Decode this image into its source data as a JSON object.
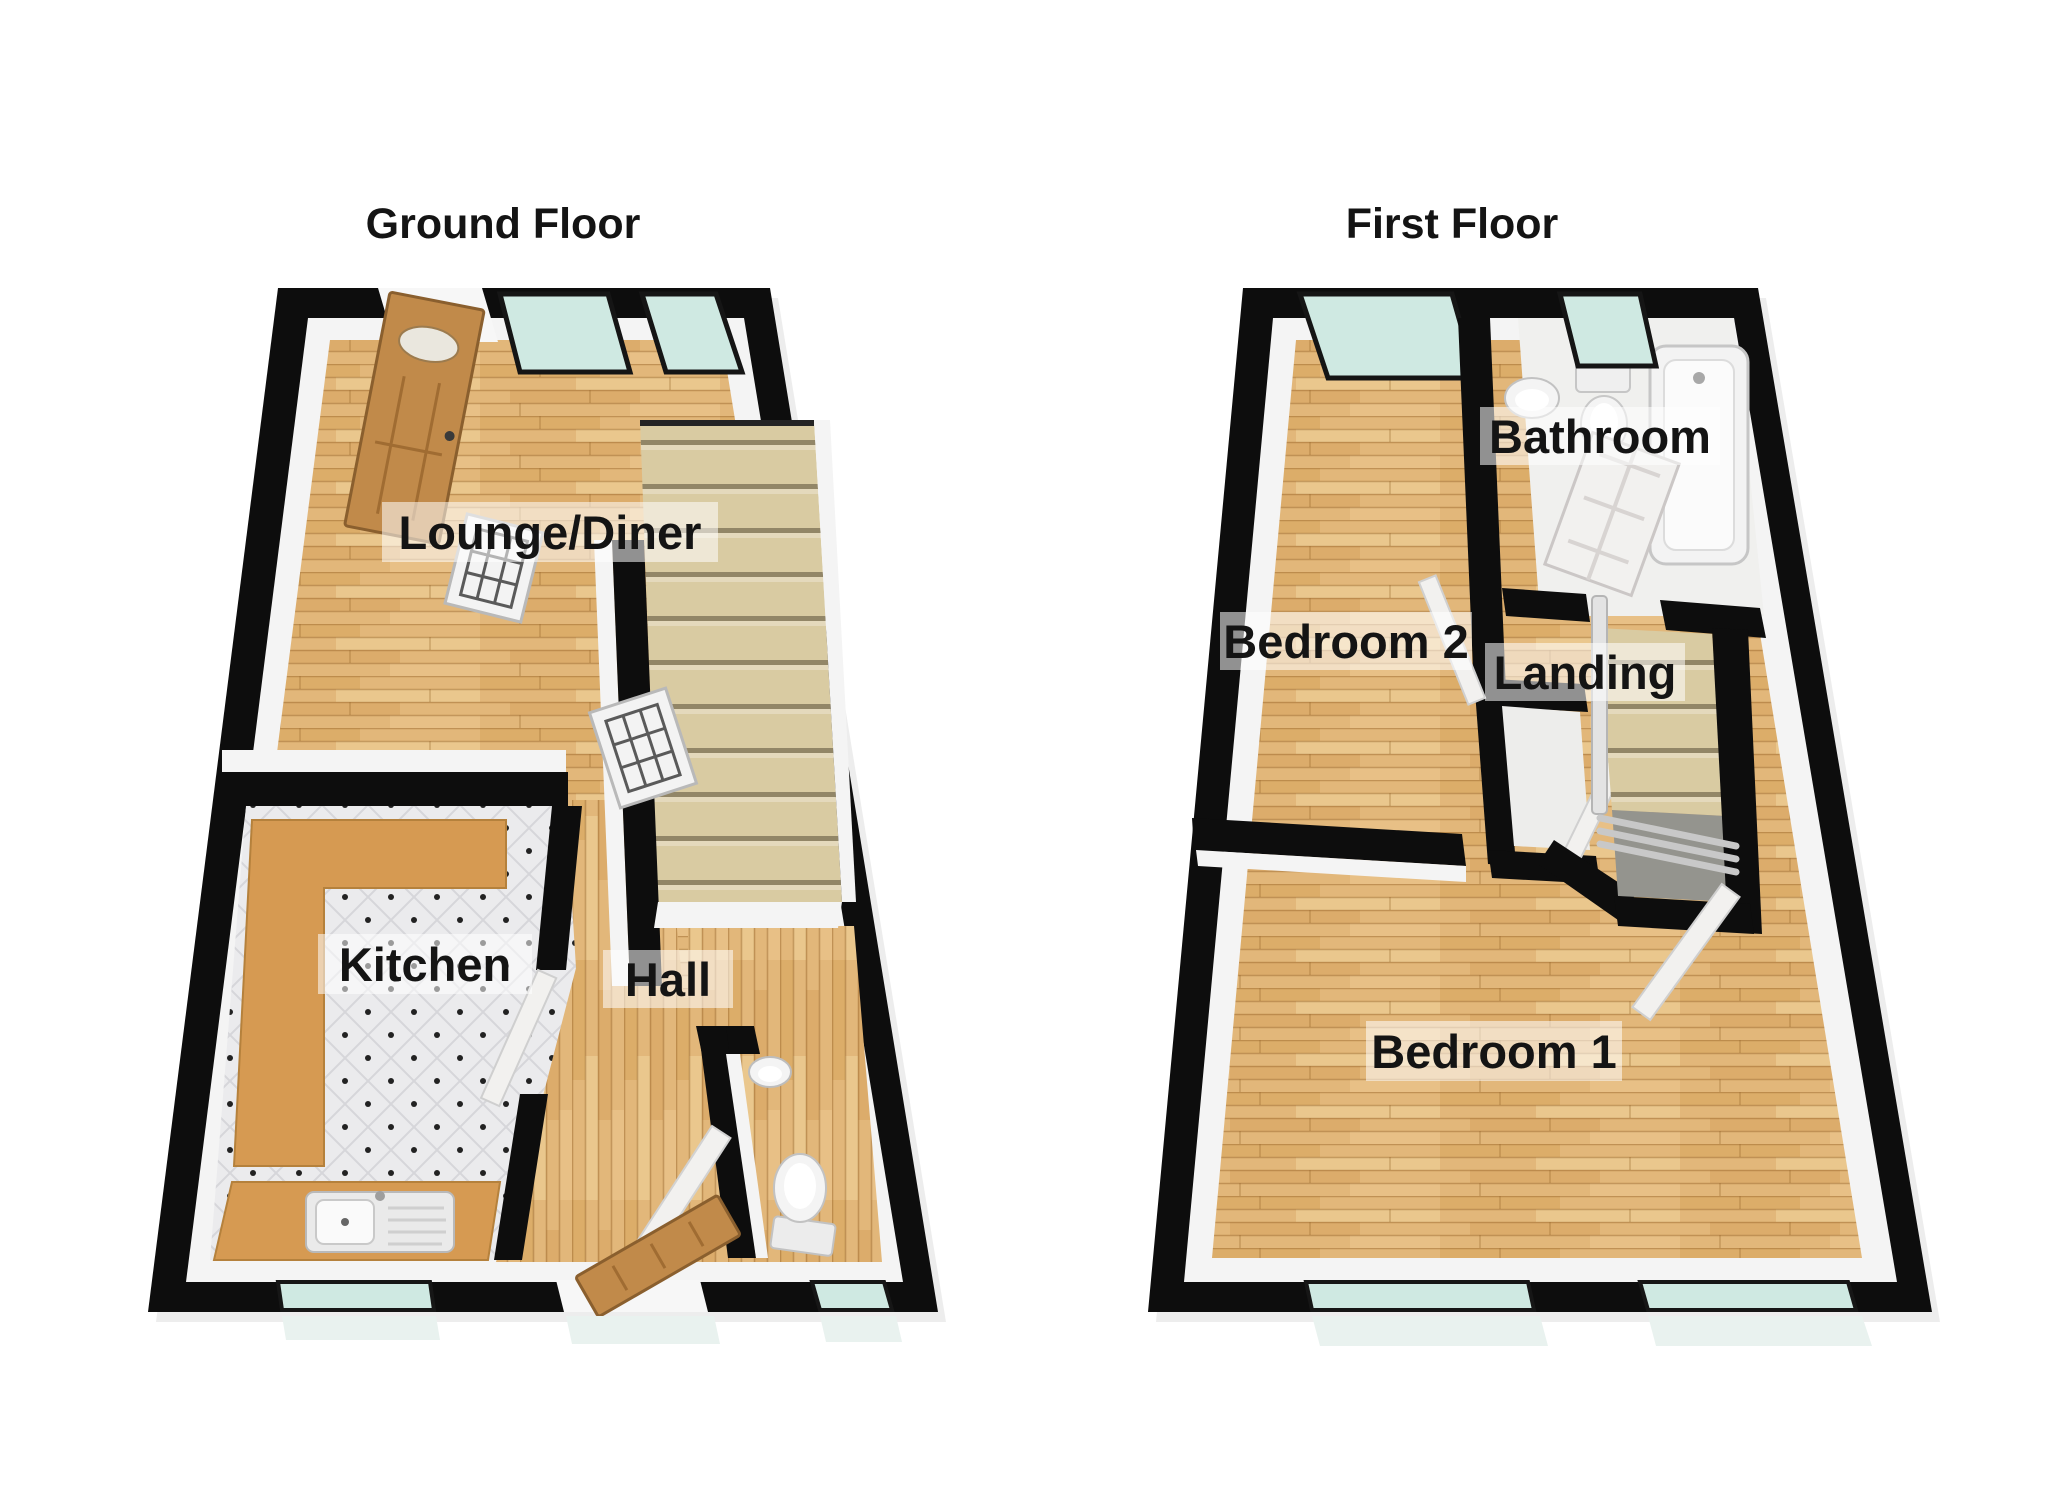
{
  "canvas": {
    "width": 2048,
    "height": 1489,
    "background": "#ffffff"
  },
  "floors": [
    {
      "title": "Ground Floor",
      "rooms": [
        {
          "name": "Lounge/Diner"
        },
        {
          "name": "Kitchen"
        },
        {
          "name": "Hall"
        }
      ]
    },
    {
      "title": "First Floor",
      "rooms": [
        {
          "name": "Bedroom 2"
        },
        {
          "name": "Landing"
        },
        {
          "name": "Bathroom"
        },
        {
          "name": "Bedroom 1"
        }
      ]
    }
  ],
  "colors": {
    "wall": "#0d0d0d",
    "wall_face": "#f4f4f4",
    "wood_base": "#e2b77a",
    "tile_base": "#ebebed",
    "glass": "#cfe9e2",
    "glass_step": "#e9f2ef",
    "counter": "#d69a52",
    "stair": "#d9cba2",
    "stair_shadow": "#94948e",
    "door_wood": "#c18a4a",
    "door_white": "#f2f1ef",
    "fixture": "#f4f4f4",
    "railing": "#c8c8c8",
    "label_bg": "rgba(255,255,255,0.55)",
    "label_text": "#141414"
  }
}
